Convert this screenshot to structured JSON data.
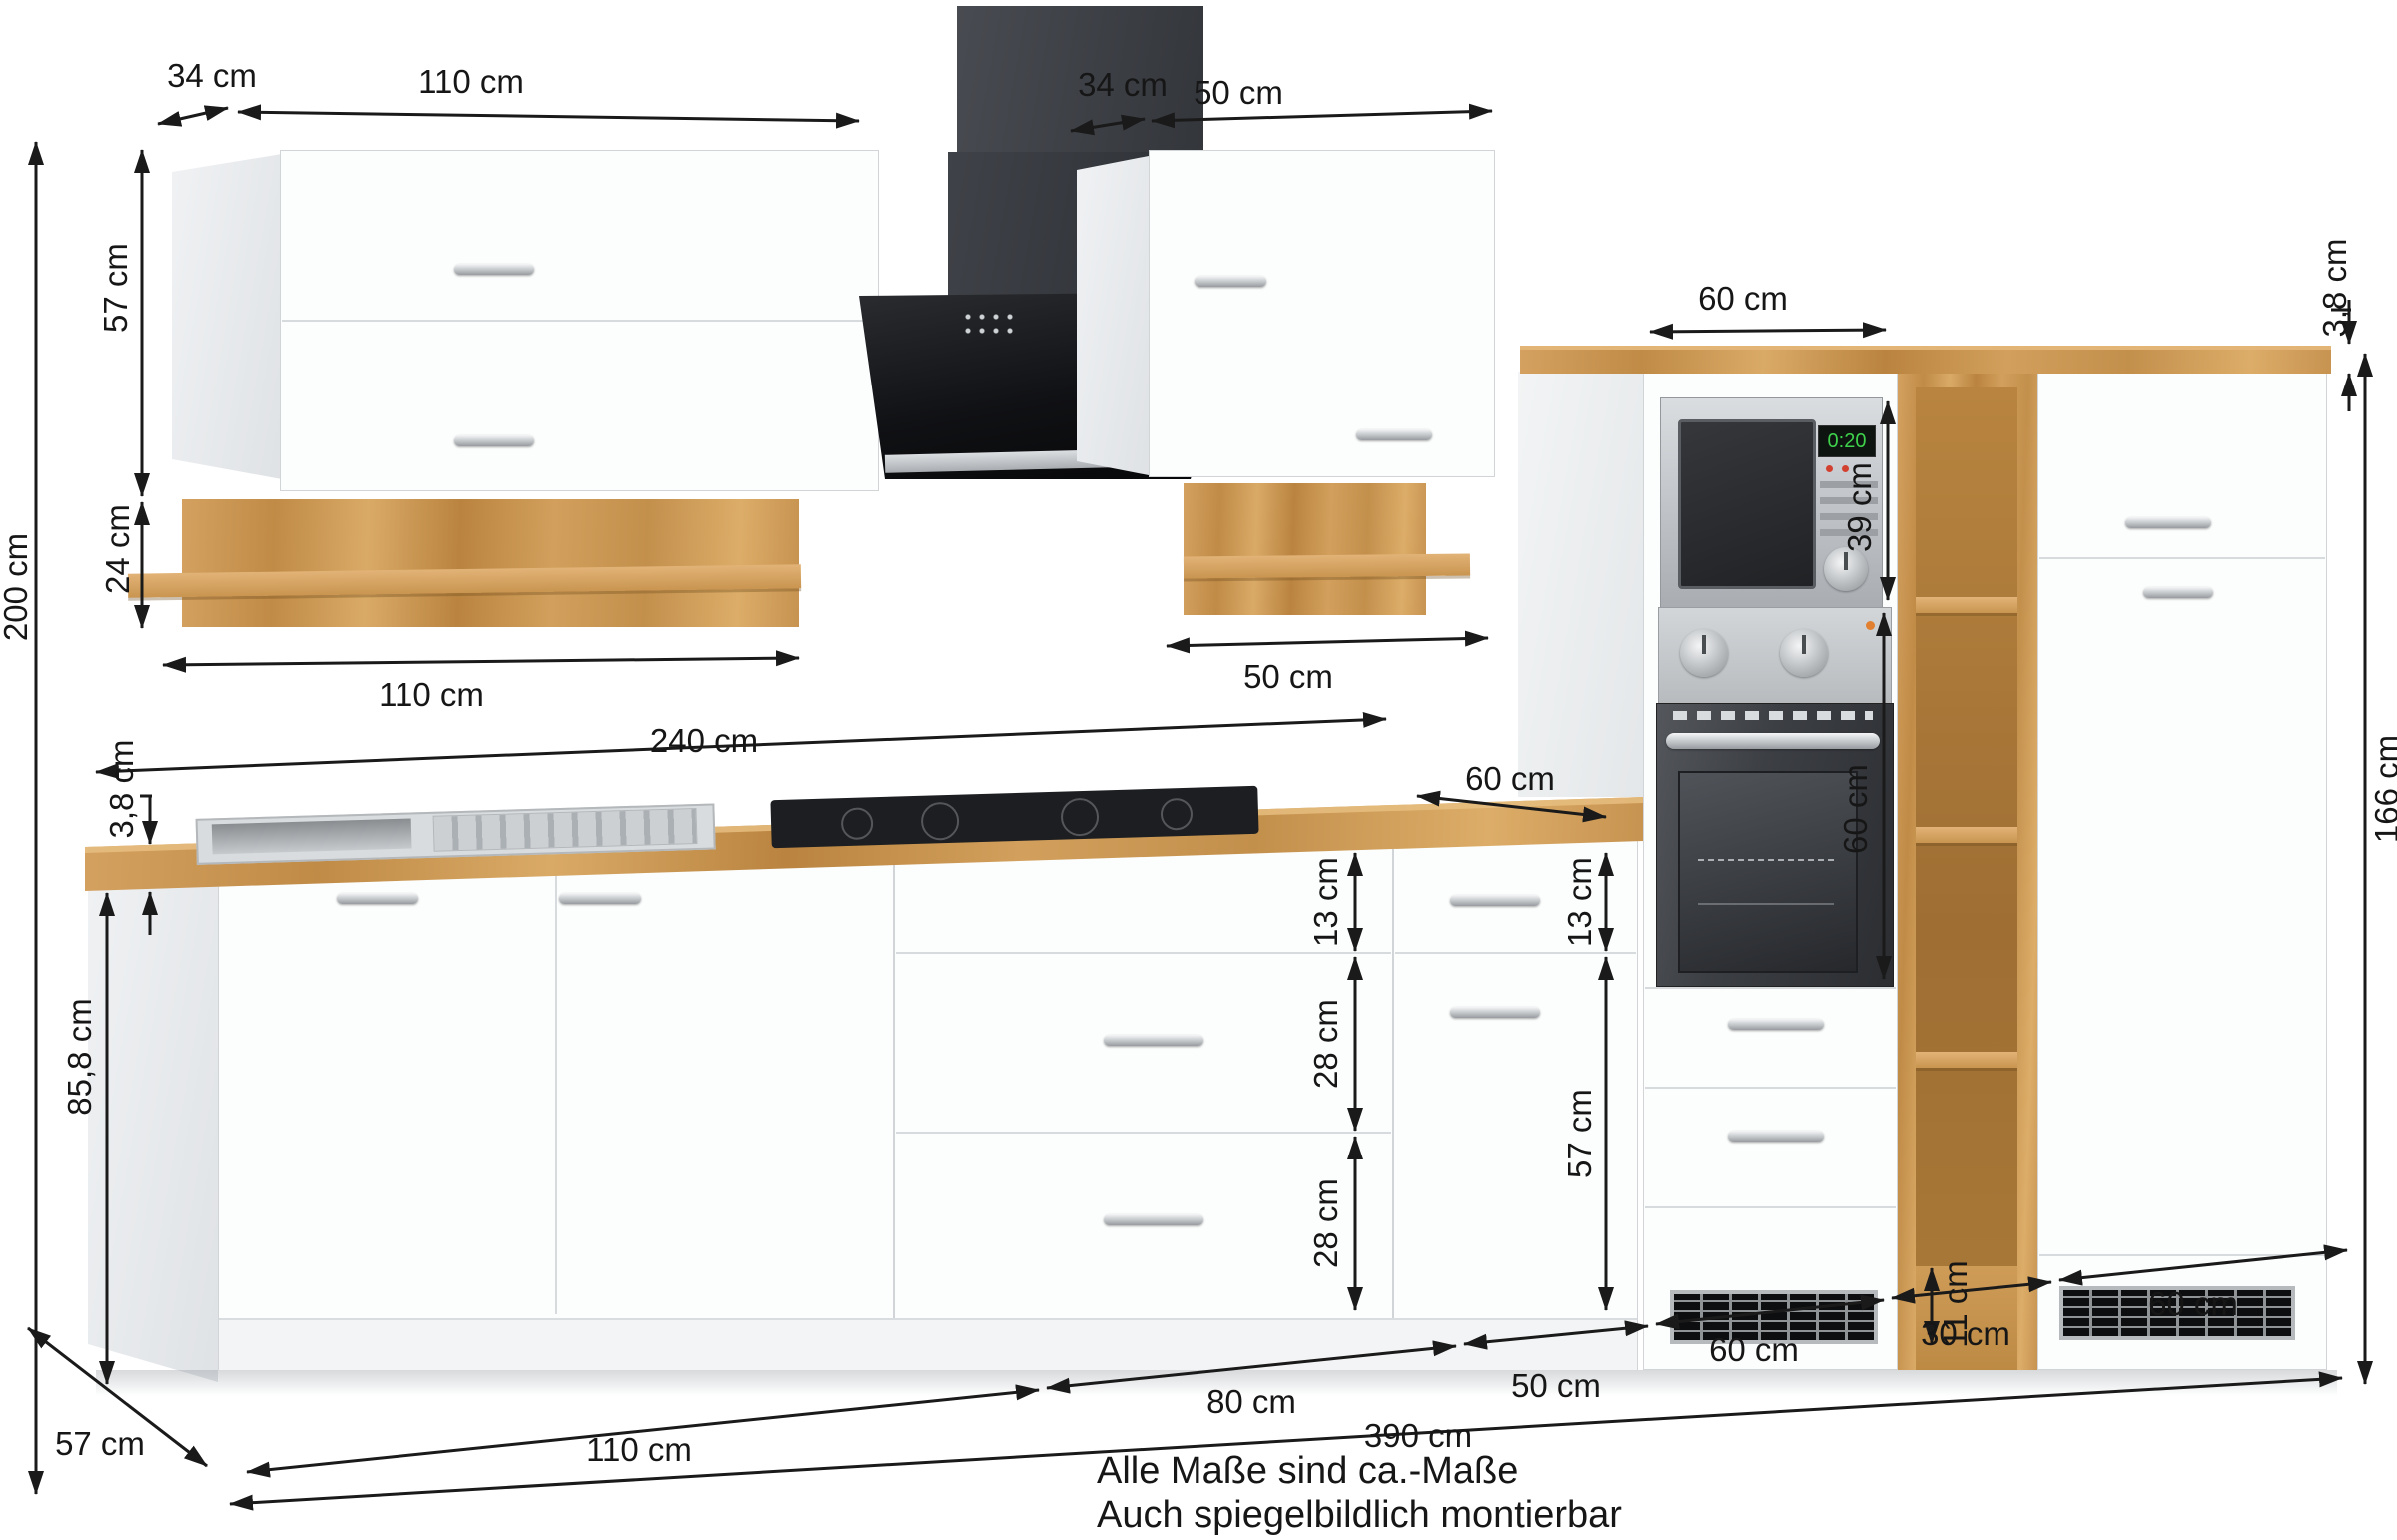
{
  "notes": {
    "line1": "Alle Maße sind ca.-Maße",
    "line2": "Auch spiegelbildlich montierbar"
  },
  "appliances": {
    "microwave_display": "0:20"
  },
  "colors": {
    "wood": "#c99550",
    "cabinet": "#fcfdfd",
    "hood": "#1a1c1f",
    "dim_line": "#1a1a1a"
  },
  "dims": {
    "total_height": "200 cm",
    "upper_left_depth": "34 cm",
    "upper_left_width_top": "110 cm",
    "upper_left_height": "57 cm",
    "wall_shelf_left_height": "24 cm",
    "wall_shelf_left_width": "110 cm",
    "upper_right_depth": "34 cm",
    "upper_right_width": "50 cm",
    "wall_shelf_right_width": "50 cm",
    "worktop_length": "240 cm",
    "worktop_depth": "60 cm",
    "worktop_thickness_left": "3,8 cm",
    "base_height": "85,8 cm",
    "tall_top_width": "60 cm",
    "tall_top_thickness": "3,8 cm",
    "microwave_height": "39 cm",
    "oven_height": "60 cm",
    "tall_units_height": "166 cm",
    "drawer13_left": "13 cm",
    "drawer28_upper": "28 cm",
    "drawer28_lower": "28 cm",
    "drawer13_right": "13 cm",
    "door57_right": "57 cm",
    "shelf_base_height": "11 cm",
    "depth": "57 cm",
    "width_110": "110 cm",
    "width_80": "80 cm",
    "width_50": "50 cm",
    "width_60_oven": "60 cm",
    "width_30": "30 cm",
    "width_60_tall": "60 cm",
    "total_width": "390 cm"
  }
}
